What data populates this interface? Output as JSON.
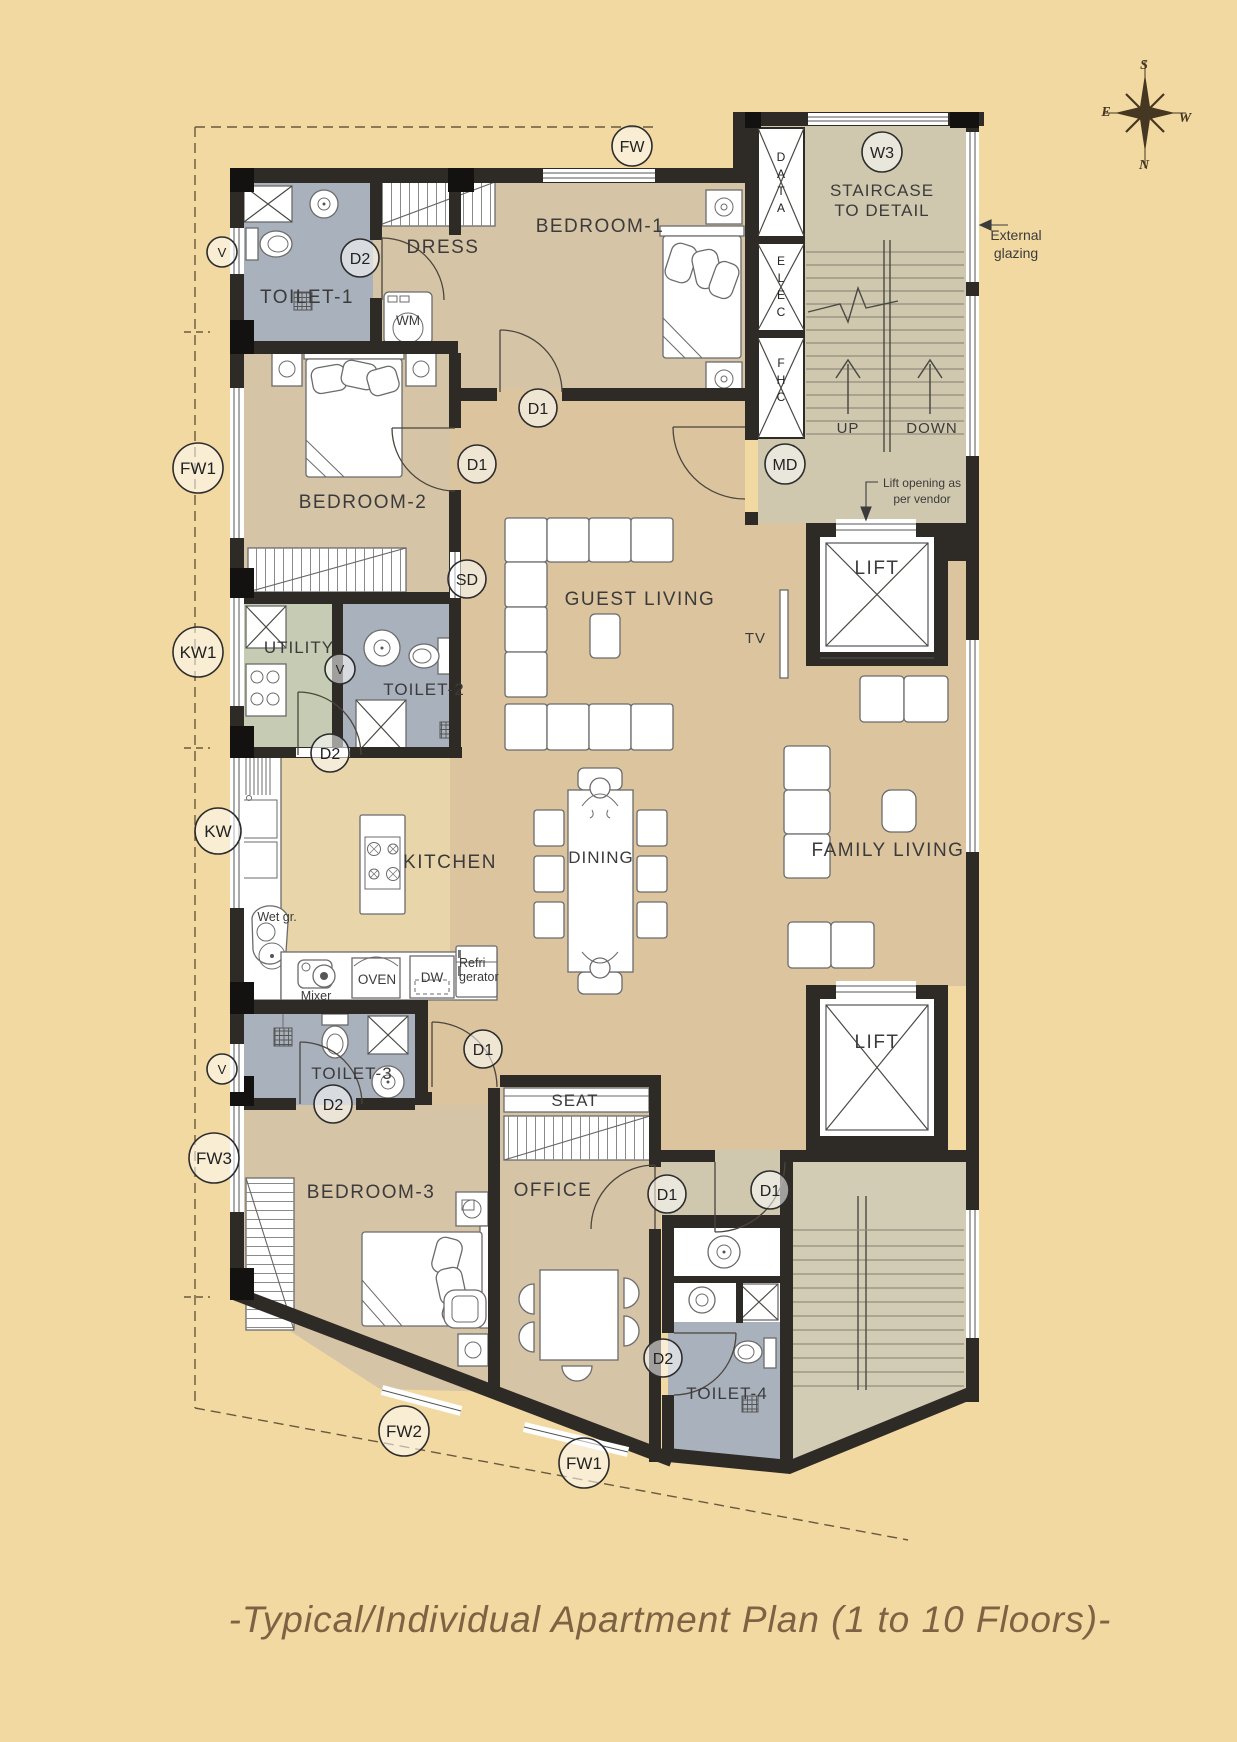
{
  "title": "-Typical/Individual Apartment Plan (1 to 10 Floors)-",
  "compass": {
    "north": "N",
    "south": "S",
    "east": "E",
    "west": "W"
  },
  "rooms": {
    "toilet1": "TOILET-1",
    "dress": "DRESS",
    "bedroom1": "BEDROOM-1",
    "bedroom2": "BEDROOM-2",
    "utility": "UTILITY",
    "toilet2": "TOILET-2",
    "guest_living": "GUEST LIVING",
    "kitchen": "KITCHEN",
    "dining": "DINING",
    "family_living": "FAMILY LIVING",
    "toilet3": "TOILET-3",
    "bedroom3": "BEDROOM-3",
    "seat": "SEAT",
    "office": "OFFICE",
    "toilet4": "TOILET-4",
    "lift_upper": "LIFT",
    "lift_lower": "LIFT",
    "staircase_line1": "STAIRCASE",
    "staircase_line2": "TO DETAIL"
  },
  "stair": {
    "up": "UP",
    "down": "DOWN"
  },
  "shafts": {
    "data": "DATA",
    "elec": "ELEC",
    "fhc": "FHC"
  },
  "appliances": {
    "wm": "WM",
    "tv": "TV",
    "wet_grinder": "Wet gr.",
    "mixer": "Mixer",
    "oven": "OVEN",
    "dishwasher": "DW",
    "refrigerator_line1": "Refri",
    "refrigerator_line2": "gerator"
  },
  "annotations": {
    "external_glazing_line1": "External",
    "external_glazing_line2": "glazing",
    "lift_opening_line1": "Lift opening as",
    "lift_opening_line2": "per vendor"
  },
  "markers": [
    {
      "label": "FW"
    },
    {
      "label": "W3"
    },
    {
      "label": "V"
    },
    {
      "label": "D2"
    },
    {
      "label": "D1"
    },
    {
      "label": "D1"
    },
    {
      "label": "MD"
    },
    {
      "label": "FW1"
    },
    {
      "label": "KW1"
    },
    {
      "label": "V"
    },
    {
      "label": "SD"
    },
    {
      "label": "D2"
    },
    {
      "label": "KW"
    },
    {
      "label": "V"
    },
    {
      "label": "D2"
    },
    {
      "label": "D1"
    },
    {
      "label": "FW3"
    },
    {
      "label": "D1"
    },
    {
      "label": "D1"
    },
    {
      "label": "D2"
    },
    {
      "label": "FW2"
    },
    {
      "label": "FW1"
    }
  ],
  "colors": {
    "background": "#f2d9a1",
    "wall": "#2e2a26",
    "bedroom_floor": "#d6c4a7",
    "living_floor": "#dcc59e",
    "kitchen_floor": "#e8d5a9",
    "toilet_floor": "#a9b2bc",
    "utility_floor": "#c6ccb3",
    "stair_floor": "#cfc8af",
    "title": "#7d6243"
  }
}
